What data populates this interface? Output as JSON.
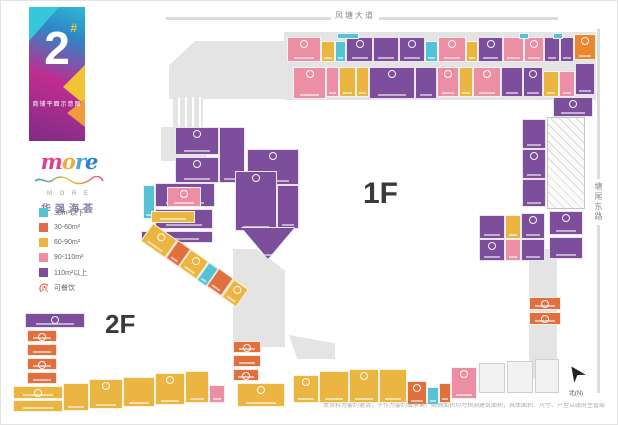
{
  "banner": {
    "number": "2",
    "hash": "#",
    "subtitle": "商铺平面示意图"
  },
  "logo": {
    "brand_letters": [
      {
        "ch": "m",
        "color": "#E23E8C"
      },
      {
        "ch": "o",
        "color": "#F2A93B"
      },
      {
        "ch": "r",
        "color": "#3FA9D9"
      },
      {
        "ch": "e",
        "color": "#2E7FC6"
      }
    ],
    "sub": "M O R E",
    "cn": "华强海荟"
  },
  "legend": {
    "items": [
      {
        "label": "30m²以下",
        "color": "#56C3D5"
      },
      {
        "label": "30-60m²",
        "color": "#DE6F4C"
      },
      {
        "label": "60-90m²",
        "color": "#EBB542"
      },
      {
        "label": "90-110m²",
        "color": "#EC8FA4"
      },
      {
        "label": "110m²以上",
        "color": "#7C4E9B"
      },
      {
        "label": "可餐饮",
        "icon": "dining-icon",
        "color": "#D95B43"
      }
    ]
  },
  "roads": {
    "top": "风塘大道",
    "right": "塘尾东路"
  },
  "floor_labels": {
    "f1": "1F",
    "f2": "2F"
  },
  "compass_label": "北(N)",
  "disclaimer": "本资料为要约邀请，不作为要约或承诺；商铺面积均为预测建筑面积，具体面积、尺寸、户型以政府主管部门最终核准文件及双方签订的商品房买卖合同约定为准；本公司保留对本宣传资料的解释权及修改权，敬请留意最新资料。",
  "plan": {
    "palette": {
      "P": "#EC8FA4",
      "U": "#7C4E9B",
      "C": "#56C3D5",
      "Y": "#EBB542",
      "O": "#E0713F",
      "O2": "#E8872F"
    },
    "grays": [
      {
        "x": 283,
        "y": 31,
        "w": 312,
        "h": 68
      },
      {
        "x": 168,
        "y": 40,
        "w": 118,
        "h": 58,
        "clip": "polygon(22% 0,100% 0,100% 100%,0 100%,0 42%)"
      },
      {
        "x": 172,
        "y": 96,
        "w": 30,
        "h": 32,
        "kind": "stairs"
      },
      {
        "x": 160,
        "y": 126,
        "w": 46,
        "h": 34
      },
      {
        "x": 232,
        "y": 248,
        "w": 52,
        "h": 98,
        "clip": "polygon(0 0,45% 0,100% 22%,100% 100%,0 100%)"
      },
      {
        "x": 528,
        "y": 248,
        "w": 28,
        "h": 130
      },
      {
        "x": 288,
        "y": 334,
        "w": 46,
        "h": 24,
        "clip": "polygon(0 0,100% 35%,100% 100%,18% 100%)"
      },
      {
        "x": 546,
        "y": 116,
        "w": 38,
        "h": 92,
        "kind": "hatch"
      },
      {
        "x": 478,
        "y": 362,
        "w": 26,
        "h": 30,
        "kind": "outline"
      },
      {
        "x": 506,
        "y": 360,
        "w": 26,
        "h": 32,
        "kind": "outline"
      },
      {
        "x": 534,
        "y": 358,
        "w": 24,
        "h": 34,
        "kind": "outline"
      }
    ],
    "units": [
      {
        "x": 286,
        "y": 36,
        "w": 34,
        "h": 25,
        "c": "P",
        "fb": true
      },
      {
        "x": 320,
        "y": 40,
        "w": 14,
        "h": 21,
        "c": "Y"
      },
      {
        "x": 334,
        "y": 40,
        "w": 11,
        "h": 21,
        "c": "C"
      },
      {
        "x": 345,
        "y": 36,
        "w": 27,
        "h": 25,
        "c": "U",
        "fb": true
      },
      {
        "x": 372,
        "y": 36,
        "w": 26,
        "h": 25,
        "c": "U"
      },
      {
        "x": 398,
        "y": 36,
        "w": 26,
        "h": 25,
        "c": "U",
        "fb": true
      },
      {
        "x": 424,
        "y": 40,
        "w": 13,
        "h": 21,
        "c": "C"
      },
      {
        "x": 437,
        "y": 36,
        "w": 28,
        "h": 25,
        "c": "P",
        "fb": true
      },
      {
        "x": 465,
        "y": 40,
        "w": 12,
        "h": 21,
        "c": "Y"
      },
      {
        "x": 477,
        "y": 36,
        "w": 25,
        "h": 25,
        "c": "U",
        "fb": true
      },
      {
        "x": 502,
        "y": 36,
        "w": 21,
        "h": 25,
        "c": "P"
      },
      {
        "x": 523,
        "y": 36,
        "w": 20,
        "h": 25,
        "c": "P",
        "fb": true
      },
      {
        "x": 543,
        "y": 36,
        "w": 16,
        "h": 25,
        "c": "U"
      },
      {
        "x": 559,
        "y": 36,
        "w": 14,
        "h": 25,
        "c": "U"
      },
      {
        "x": 573,
        "y": 33,
        "w": 22,
        "h": 26,
        "c": "O2",
        "fb": true
      },
      {
        "x": 336,
        "y": 32,
        "w": 22,
        "h": 6,
        "c": "C"
      },
      {
        "x": 518,
        "y": 32,
        "w": 10,
        "h": 6,
        "c": "C"
      },
      {
        "x": 552,
        "y": 32,
        "w": 10,
        "h": 6,
        "c": "C"
      },
      {
        "x": 292,
        "y": 66,
        "w": 33,
        "h": 32,
        "c": "P",
        "fb": true
      },
      {
        "x": 325,
        "y": 66,
        "w": 13,
        "h": 30,
        "c": "P"
      },
      {
        "x": 338,
        "y": 66,
        "w": 17,
        "h": 30,
        "c": "Y"
      },
      {
        "x": 355,
        "y": 66,
        "w": 13,
        "h": 30,
        "c": "Y"
      },
      {
        "x": 368,
        "y": 66,
        "w": 46,
        "h": 32,
        "c": "U",
        "fb": true
      },
      {
        "x": 414,
        "y": 66,
        "w": 22,
        "h": 32,
        "c": "U"
      },
      {
        "x": 436,
        "y": 66,
        "w": 22,
        "h": 30,
        "c": "P",
        "fb": true
      },
      {
        "x": 458,
        "y": 66,
        "w": 14,
        "h": 30,
        "c": "Y"
      },
      {
        "x": 472,
        "y": 66,
        "w": 28,
        "h": 30,
        "c": "P",
        "fb": true
      },
      {
        "x": 500,
        "y": 66,
        "w": 22,
        "h": 30,
        "c": "U"
      },
      {
        "x": 522,
        "y": 66,
        "w": 20,
        "h": 30,
        "c": "U",
        "fb": true
      },
      {
        "x": 542,
        "y": 70,
        "w": 16,
        "h": 26,
        "c": "Y"
      },
      {
        "x": 558,
        "y": 70,
        "w": 16,
        "h": 26,
        "c": "P"
      },
      {
        "x": 574,
        "y": 62,
        "w": 20,
        "h": 32,
        "c": "U"
      },
      {
        "x": 552,
        "y": 96,
        "w": 40,
        "h": 20,
        "c": "U",
        "fb": true
      },
      {
        "x": 521,
        "y": 118,
        "w": 24,
        "h": 30,
        "c": "U"
      },
      {
        "x": 521,
        "y": 148,
        "w": 24,
        "h": 30,
        "c": "U",
        "fb": true
      },
      {
        "x": 521,
        "y": 178,
        "w": 24,
        "h": 28,
        "c": "U"
      },
      {
        "x": 548,
        "y": 210,
        "w": 34,
        "h": 24,
        "c": "U",
        "fb": true
      },
      {
        "x": 548,
        "y": 236,
        "w": 34,
        "h": 22,
        "c": "U"
      },
      {
        "x": 478,
        "y": 214,
        "w": 26,
        "h": 24,
        "c": "U"
      },
      {
        "x": 478,
        "y": 238,
        "w": 26,
        "h": 22,
        "c": "U",
        "fb": true
      },
      {
        "x": 504,
        "y": 214,
        "w": 16,
        "h": 24,
        "c": "Y"
      },
      {
        "x": 504,
        "y": 238,
        "w": 16,
        "h": 22,
        "c": "P"
      },
      {
        "x": 520,
        "y": 212,
        "w": 24,
        "h": 26,
        "c": "U",
        "fb": true
      },
      {
        "x": 520,
        "y": 238,
        "w": 24,
        "h": 22,
        "c": "U"
      },
      {
        "x": 528,
        "y": 296,
        "w": 32,
        "h": 13,
        "c": "O",
        "fb": true
      },
      {
        "x": 528,
        "y": 311,
        "w": 32,
        "h": 13,
        "c": "O",
        "fb": true
      },
      {
        "x": 174,
        "y": 126,
        "w": 44,
        "h": 28,
        "c": "U",
        "fb": true
      },
      {
        "x": 174,
        "y": 156,
        "w": 44,
        "h": 26,
        "c": "U",
        "fb": true
      },
      {
        "x": 218,
        "y": 126,
        "w": 26,
        "h": 56,
        "c": "U"
      },
      {
        "x": 142,
        "y": 184,
        "w": 12,
        "h": 34,
        "c": "C"
      },
      {
        "x": 154,
        "y": 182,
        "w": 60,
        "h": 24,
        "c": "U"
      },
      {
        "x": 166,
        "y": 186,
        "w": 34,
        "h": 20,
        "c": "P",
        "fb": true
      },
      {
        "x": 154,
        "y": 208,
        "w": 58,
        "h": 20,
        "c": "U",
        "fb": true
      },
      {
        "x": 140,
        "y": 230,
        "w": 72,
        "h": 12,
        "c": "U"
      },
      {
        "x": 246,
        "y": 148,
        "w": 52,
        "h": 36,
        "c": "U",
        "fb": true
      },
      {
        "x": 234,
        "y": 170,
        "w": 42,
        "h": 60,
        "c": "U",
        "fb": true
      },
      {
        "x": 276,
        "y": 184,
        "w": 22,
        "h": 44,
        "c": "U"
      },
      {
        "x": 240,
        "y": 226,
        "w": 54,
        "h": 32,
        "c": "U",
        "clip": "polygon(0 0,100% 0,50% 100%)"
      },
      {
        "x": 150,
        "y": 210,
        "w": 44,
        "h": 12,
        "c": "Y"
      },
      {
        "x": 152,
        "y": 222,
        "w": 30,
        "h": 22,
        "c": "Y",
        "fb": true,
        "rot": 35
      },
      {
        "x": 177,
        "y": 239,
        "w": 16,
        "h": 22,
        "c": "O",
        "rot": 35
      },
      {
        "x": 190,
        "y": 248,
        "w": 22,
        "h": 22,
        "c": "Y",
        "fb": true,
        "rot": 35
      },
      {
        "x": 208,
        "y": 261,
        "w": 12,
        "h": 22,
        "c": "C",
        "rot": 35
      },
      {
        "x": 218,
        "y": 267,
        "w": 18,
        "h": 22,
        "c": "O",
        "rot": 35
      },
      {
        "x": 233,
        "y": 278,
        "w": 18,
        "h": 22,
        "c": "Y",
        "fb": true,
        "rot": 35
      },
      {
        "x": 24,
        "y": 312,
        "w": 60,
        "h": 15,
        "c": "U",
        "fb": true
      },
      {
        "x": 26,
        "y": 329,
        "w": 30,
        "h": 12,
        "c": "O",
        "fb": true
      },
      {
        "x": 26,
        "y": 343,
        "w": 30,
        "h": 12,
        "c": "O"
      },
      {
        "x": 26,
        "y": 357,
        "w": 30,
        "h": 12,
        "c": "O",
        "fb": true
      },
      {
        "x": 26,
        "y": 371,
        "w": 30,
        "h": 12,
        "c": "O"
      },
      {
        "x": 12,
        "y": 385,
        "w": 50,
        "h": 13,
        "c": "Y",
        "fb": true
      },
      {
        "x": 12,
        "y": 399,
        "w": 50,
        "h": 12,
        "c": "Y"
      },
      {
        "x": 62,
        "y": 382,
        "w": 26,
        "h": 28,
        "c": "Y"
      },
      {
        "x": 88,
        "y": 378,
        "w": 34,
        "h": 30,
        "c": "Y",
        "fb": true
      },
      {
        "x": 122,
        "y": 376,
        "w": 32,
        "h": 30,
        "c": "Y"
      },
      {
        "x": 154,
        "y": 372,
        "w": 30,
        "h": 32,
        "c": "Y",
        "fb": true
      },
      {
        "x": 184,
        "y": 370,
        "w": 24,
        "h": 32,
        "c": "Y"
      },
      {
        "x": 208,
        "y": 384,
        "w": 16,
        "h": 18,
        "c": "P"
      },
      {
        "x": 232,
        "y": 340,
        "w": 28,
        "h": 12,
        "c": "O",
        "fb": true
      },
      {
        "x": 232,
        "y": 354,
        "w": 28,
        "h": 12,
        "c": "O"
      },
      {
        "x": 232,
        "y": 368,
        "w": 26,
        "h": 12,
        "c": "O",
        "fb": true
      },
      {
        "x": 236,
        "y": 382,
        "w": 48,
        "h": 24,
        "c": "Y",
        "fb": true
      },
      {
        "x": 292,
        "y": 374,
        "w": 26,
        "h": 28,
        "c": "Y",
        "fb": true
      },
      {
        "x": 318,
        "y": 370,
        "w": 30,
        "h": 32,
        "c": "Y"
      },
      {
        "x": 348,
        "y": 368,
        "w": 30,
        "h": 34,
        "c": "Y",
        "fb": true
      },
      {
        "x": 378,
        "y": 368,
        "w": 28,
        "h": 34,
        "c": "Y"
      },
      {
        "x": 406,
        "y": 380,
        "w": 20,
        "h": 24,
        "c": "O",
        "fb": true
      },
      {
        "x": 426,
        "y": 386,
        "w": 12,
        "h": 18,
        "c": "C"
      },
      {
        "x": 438,
        "y": 382,
        "w": 12,
        "h": 20,
        "c": "O"
      },
      {
        "x": 450,
        "y": 366,
        "w": 26,
        "h": 32,
        "c": "P",
        "fb": true
      }
    ]
  }
}
